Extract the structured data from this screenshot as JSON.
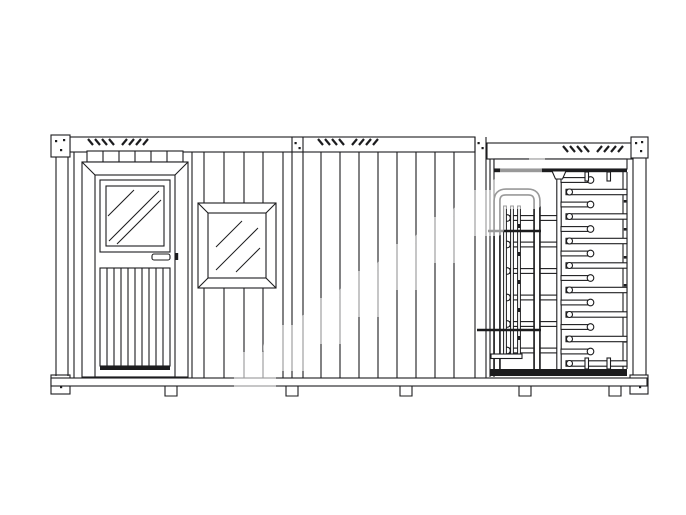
{
  "palette": {
    "background": "#ffffff",
    "line": "#1c1c1e",
    "paper": "#ffffff",
    "watermark": "#ffffff"
  },
  "watermark": {
    "opacity": 0.55,
    "blob_count": 8
  },
  "frame": {
    "corner_fittings": 4,
    "vent_groups": 6,
    "vent_dashes_per_group": 4,
    "junction_posts": 2,
    "feet": 5
  },
  "sections": {
    "office": {
      "label": "container office with door and window",
      "door_louver_slats": 9,
      "door_transom_cells": 6,
      "door_glass_hatch": 3,
      "window_glass_hatch": 3,
      "wall_ridges_full": 3,
      "wall_ridges_split": 4
    },
    "wall": {
      "label": "corrugated wall panel",
      "ridges": 8
    },
    "turnstile": {
      "label": "full height turnstile",
      "fixed_bars": 8,
      "rotor_arms_right": 8,
      "rotor_arms_left": 6,
      "cage_bars": 3,
      "cage_bolts": 5,
      "channel_bolts": 6,
      "crossbars": 2,
      "stubs": 4
    }
  }
}
